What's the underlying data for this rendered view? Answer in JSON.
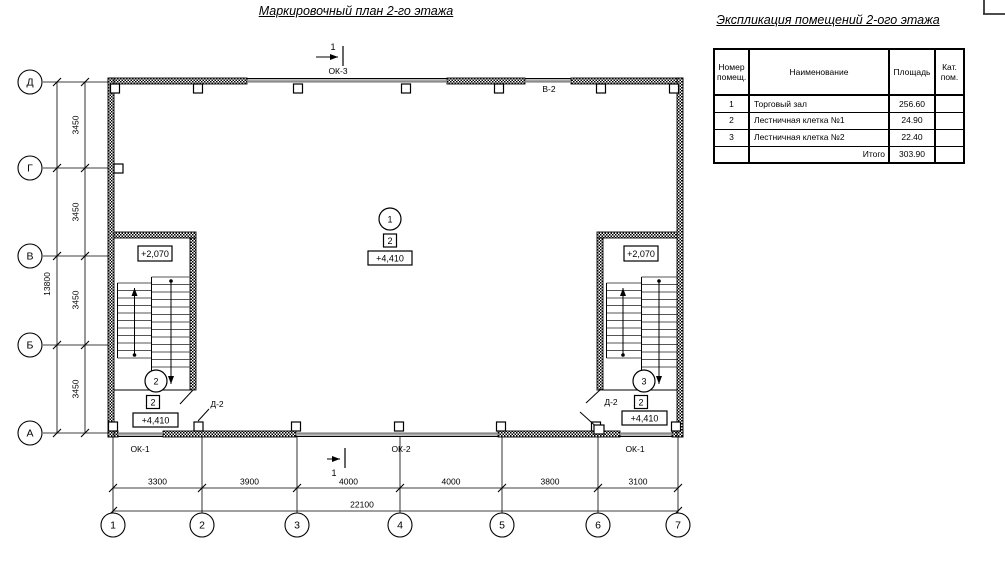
{
  "titles": {
    "plan": "Маркировочный план 2-го этажа",
    "explication": "Экспликация помещений 2-ого этажа"
  },
  "plan": {
    "row_axes": [
      "Д",
      "Г",
      "В",
      "Б",
      "А"
    ],
    "col_axes": [
      "1",
      "2",
      "3",
      "4",
      "5",
      "6",
      "7"
    ],
    "dim_row_segments": [
      "3450",
      "3450",
      "3450",
      "3450"
    ],
    "dim_row_total": "13800",
    "dim_col_segments": [
      "3300",
      "3900",
      "4000",
      "4000",
      "3800",
      "3100"
    ],
    "dim_col_total": "22100",
    "section_mark": "1",
    "windows": {
      "top": "ОК-3",
      "top_right": "В-2",
      "bottom_left": "ОК-1",
      "bottom_center": "ОК-2",
      "bottom_right": "ОК-1"
    },
    "doors": {
      "left": "Д-2",
      "right": "Д-2"
    },
    "markers": {
      "hall": {
        "num": "1",
        "cat": "2",
        "elev": "+4,410"
      },
      "stair_left": {
        "num": "2",
        "cat": "2",
        "elev": "+4,410",
        "mid": "+2,070"
      },
      "stair_right": {
        "num": "3",
        "cat": "2",
        "elev": "+4,410",
        "mid": "+2,070"
      }
    }
  },
  "table": {
    "headers": {
      "num": "Номер помещ.",
      "name": "Наименование",
      "area": "Площадь",
      "cat": "Кат. пом."
    },
    "rows": [
      {
        "num": "1",
        "name": "Торговый зал",
        "area": "256.60",
        "cat": ""
      },
      {
        "num": "2",
        "name": "Лестничная клетка №1",
        "area": "24.90",
        "cat": ""
      },
      {
        "num": "3",
        "name": "Лестничная клетка №2",
        "area": "22.40",
        "cat": ""
      }
    ],
    "total_label": "Итого",
    "total_value": "303.90"
  }
}
